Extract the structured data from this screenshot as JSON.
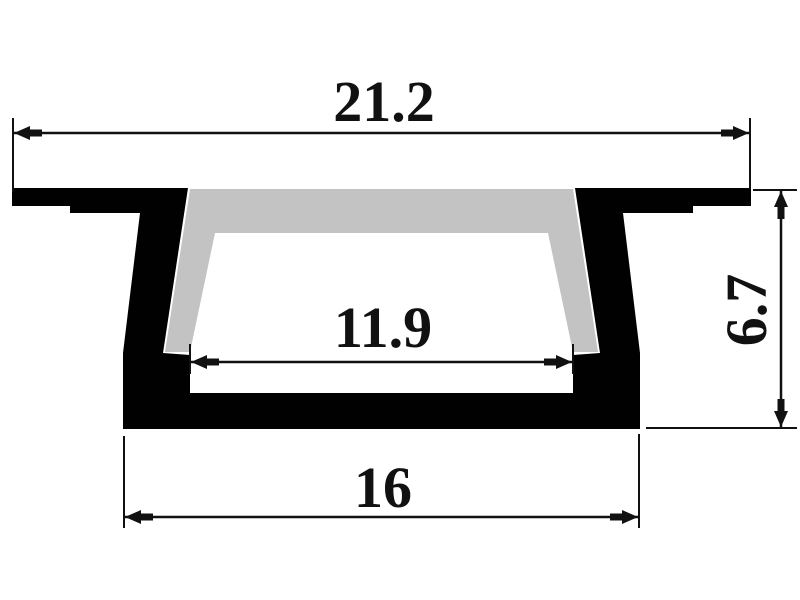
{
  "drawing": {
    "dimensions": [
      {
        "name": "top-width",
        "label": "21.2"
      },
      {
        "name": "inner-width",
        "label": "11.9"
      },
      {
        "name": "bottom-width",
        "label": "16"
      },
      {
        "name": "height",
        "label": "6.7"
      }
    ],
    "colors": {
      "profile": "#010101",
      "diffuser": "#c3c3c3",
      "dimension_lines": "#111111",
      "background": "#ffffff"
    }
  }
}
